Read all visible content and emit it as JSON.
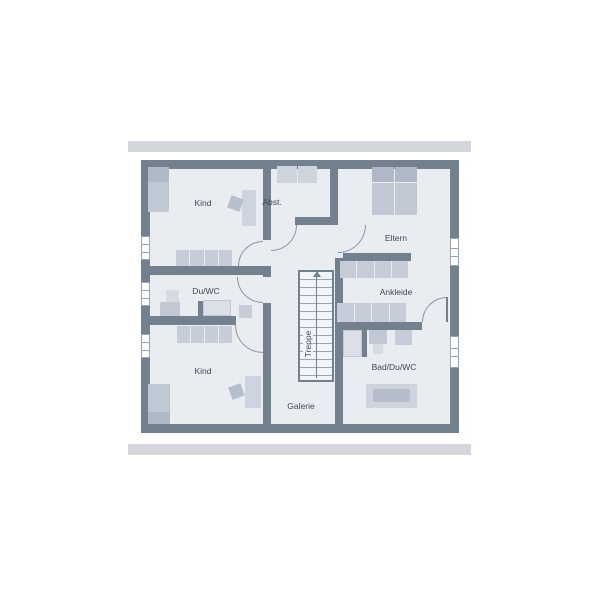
{
  "colors": {
    "wall": "#73808e",
    "room": "#e9edf2",
    "band": "#d3d6db",
    "line": "#8b96a3",
    "text": "#3d4854",
    "furniture": "#c6cdd8",
    "furniture_dark": "#aeb8c6",
    "window": "#ffffff"
  },
  "rooms": {
    "kind_top": "Kind",
    "abstellraum": "Abst.",
    "eltern": "Eltern",
    "du_wc": "Du/WC",
    "ankleide": "Ankleide",
    "kind_bottom": "Kind",
    "treppe": "Treppe",
    "galerie": "Galerie",
    "bad_du_wc": "Bad/Du/WC"
  }
}
